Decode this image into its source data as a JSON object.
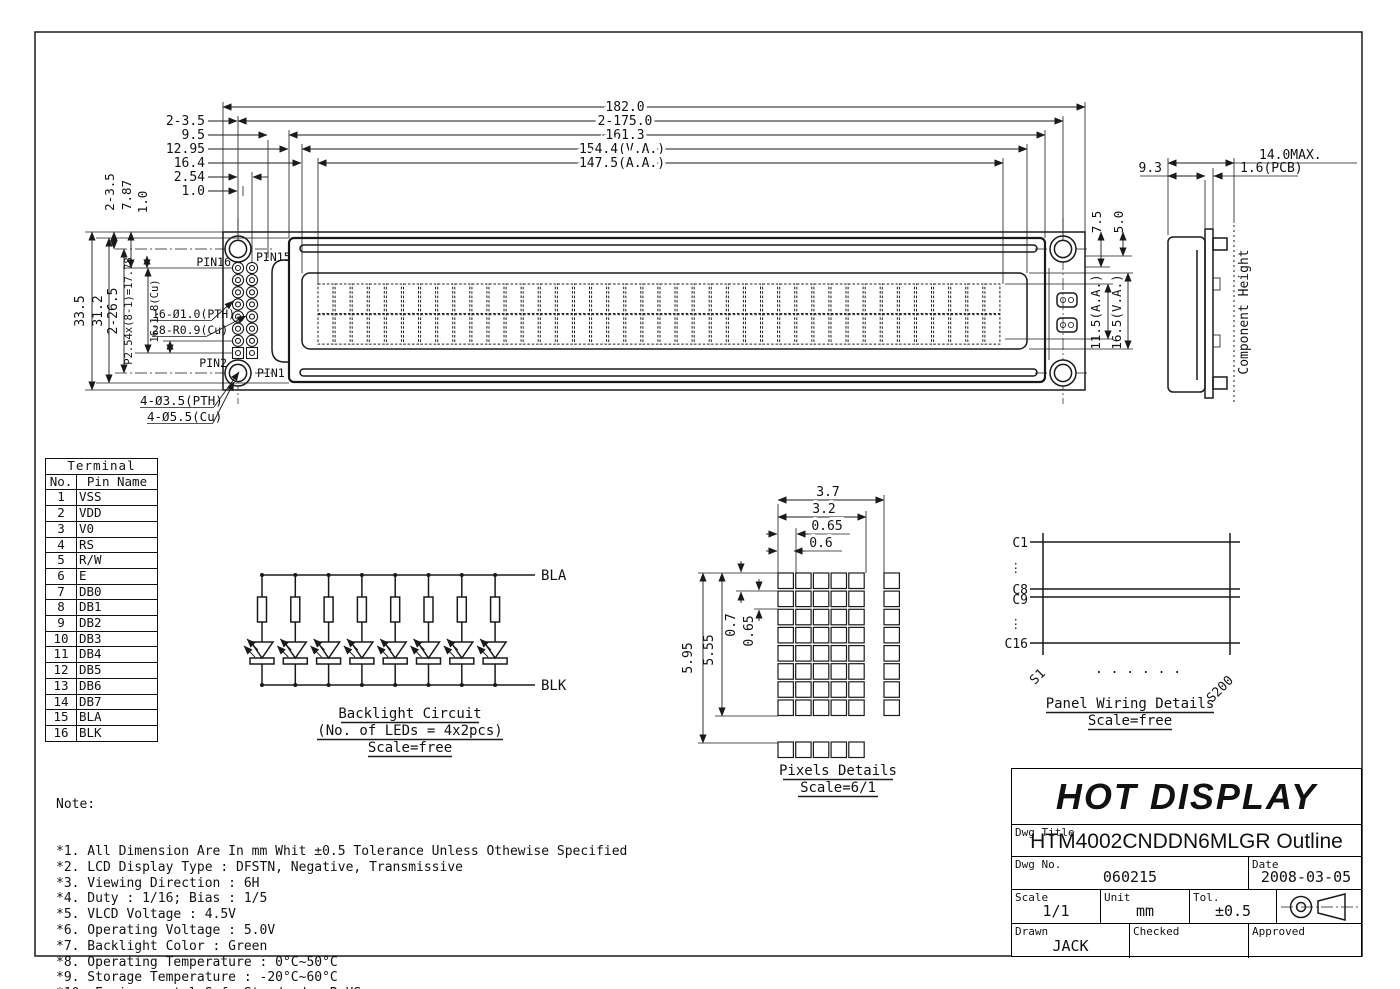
{
  "dimensions": {
    "top": [
      "182.0",
      "2-175.0",
      "161.3",
      "154.4(V.A.)",
      "147.5(A.A.)"
    ],
    "top_left_stack": [
      "2-3.5",
      "9.5",
      "12.95",
      "16.4",
      "2.54",
      "1.0"
    ],
    "pin_offsets": [
      "2-3.5",
      "7.87",
      "1.0"
    ],
    "left_vertical": [
      "33.5",
      "31.2",
      "2-26.5",
      "P2.54x(8-1)=17.78",
      "16-1.8(Cu)"
    ],
    "right_vertical": [
      "7.5",
      "5.0",
      "11.5(A.A.)",
      "16.5(V.A.)"
    ]
  },
  "front_view": {
    "pins": {
      "pin16": "PIN16",
      "pin15": "PIN15",
      "pin2": "PIN2",
      "pin1": "PIN1"
    },
    "notes": {
      "pth": "16-Ø1.0(PTH)",
      "cu": "28-R0.9(Cu)",
      "hole_pth": "4-Ø3.5(PTH)",
      "hole_cu": "4-Ø5.5(Cu)"
    },
    "display": {
      "columns": 40,
      "rows": 2
    },
    "pin_grid": {
      "cols": 2,
      "rows": 8
    }
  },
  "side_view": {
    "width_max": "14.0MAX.",
    "pcb": "1.6(PCB)",
    "depth": "9.3",
    "component_height": "Component Height"
  },
  "backlight": {
    "title": "Backlight Circuit",
    "subtitle": "(No. of LEDs = 4x2pcs)",
    "scale": "Scale=free",
    "anode": "BLA",
    "cathode": "BLK",
    "branches": 8
  },
  "pixels": {
    "title": "Pixels Details",
    "scale": "Scale=6/1",
    "h_dims": [
      "3.7",
      "3.2",
      "0.65",
      "0.6"
    ],
    "v_dims": [
      "5.95",
      "5.55",
      "0.7",
      "0.65"
    ],
    "grid": {
      "cols": 5,
      "rows": 8
    }
  },
  "panel_wiring": {
    "title": "Panel Wiring Details",
    "scale": "Scale=free",
    "rows": [
      "C1",
      "C8",
      "C9",
      "C16"
    ],
    "dots_v": "⋮",
    "dots_h": ". . . . . .",
    "first_col": "S1",
    "last_col": "S200"
  },
  "terminal_table": {
    "title": "Terminal",
    "col_no": "No.",
    "col_name": "Pin Name",
    "rows": [
      {
        "no": "1",
        "name": "VSS"
      },
      {
        "no": "2",
        "name": "VDD"
      },
      {
        "no": "3",
        "name": "V0"
      },
      {
        "no": "4",
        "name": "RS"
      },
      {
        "no": "5",
        "name": "R/W"
      },
      {
        "no": "6",
        "name": "E"
      },
      {
        "no": "7",
        "name": "DB0"
      },
      {
        "no": "8",
        "name": "DB1"
      },
      {
        "no": "9",
        "name": "DB2"
      },
      {
        "no": "10",
        "name": "DB3"
      },
      {
        "no": "11",
        "name": "DB4"
      },
      {
        "no": "12",
        "name": "DB5"
      },
      {
        "no": "13",
        "name": "DB6"
      },
      {
        "no": "14",
        "name": "DB7"
      },
      {
        "no": "15",
        "name": "BLA"
      },
      {
        "no": "16",
        "name": "BLK"
      }
    ]
  },
  "notes": {
    "heading": "Note:",
    "items": [
      "*1. All Dimension Are In mm Whit ±0.5 Tolerance Unless Othewise Specified",
      "*2. LCD Display Type : DFSTN, Negative, Transmissive",
      "*3. Viewing Direction : 6H",
      "*4. Duty : 1/16; Bias : 1/5",
      "*5. VLCD Voltage : 4.5V",
      "*6. Operating Voltage : 5.0V",
      "*7. Backlight Color : Green",
      "*8. Operating Temperature : 0°C~50°C",
      "*9. Storage Temperature : -20°C~60°C",
      "*10. Environmental Safe Standard : RoHS"
    ]
  },
  "title_block": {
    "company": "HOT DISPLAY",
    "dwg_title_label": "Dwg Title",
    "dwg_title": "HTM4002CNDDN6MLGR Outline",
    "dwg_no_label": "Dwg No.",
    "dwg_no": "060215",
    "date_label": "Date",
    "date": "2008-03-05",
    "scale_label": "Scale",
    "scale": "1/1",
    "unit_label": "Unit",
    "unit": "mm",
    "tol_label": "Tol.",
    "tol": "±0.5",
    "drawn_label": "Drawn",
    "drawn": "JACK",
    "checked_label": "Checked",
    "checked": "",
    "approved_label": "Approved",
    "approved": ""
  }
}
